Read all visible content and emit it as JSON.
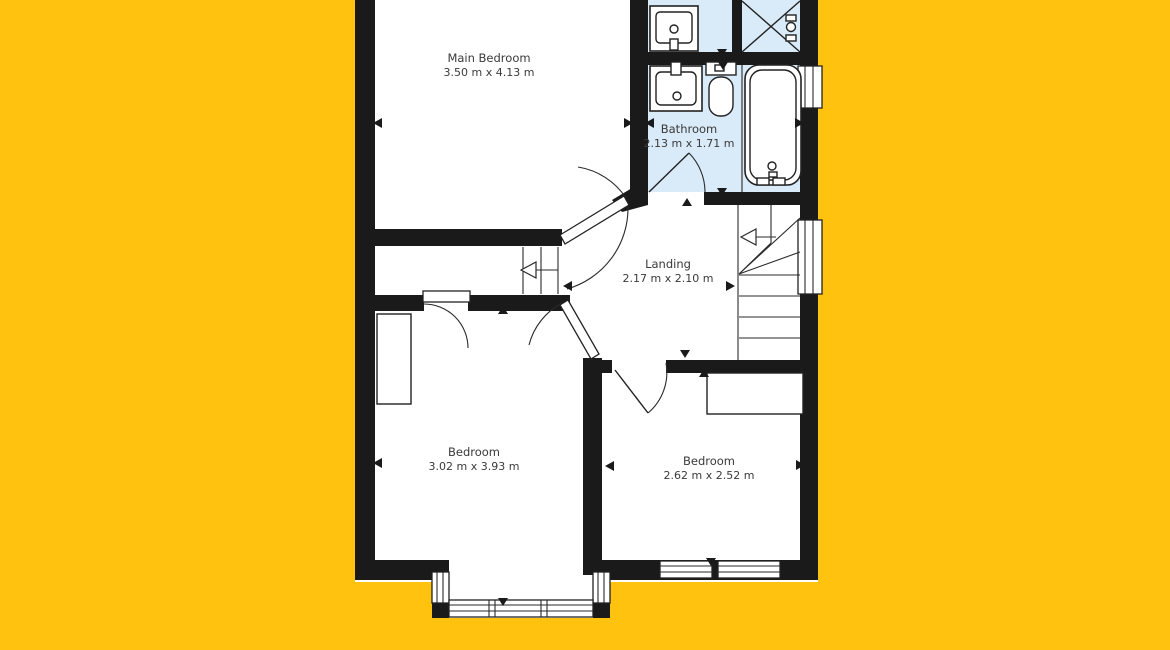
{
  "canvas": {
    "width": 1170,
    "height": 650
  },
  "colors": {
    "background": "#ffc20e",
    "wall": "#1a1a1a",
    "floor": "#ffffff",
    "wet_room": "#d9eaf8",
    "outline": "#222222",
    "label_text": "#3a3a3a"
  },
  "rooms": [
    {
      "id": "main-bedroom",
      "name": "Main Bedroom",
      "dimensions": "3.50 m x 4.13 m"
    },
    {
      "id": "bathroom",
      "name": "Bathroom",
      "dimensions": "2.13 m x 1.71 m"
    },
    {
      "id": "landing",
      "name": "Landing",
      "dimensions": "2.17 m x 2.10 m"
    },
    {
      "id": "bedroom-left",
      "name": "Bedroom",
      "dimensions": "3.02 m x 3.93 m"
    },
    {
      "id": "bedroom-right",
      "name": "Bedroom",
      "dimensions": "2.62 m x 2.52 m"
    }
  ],
  "fixtures": [
    "sink",
    "shower",
    "sink",
    "toilet",
    "bathtub"
  ],
  "icons": [
    "stair-direction-arrow",
    "dimension-pointer"
  ]
}
